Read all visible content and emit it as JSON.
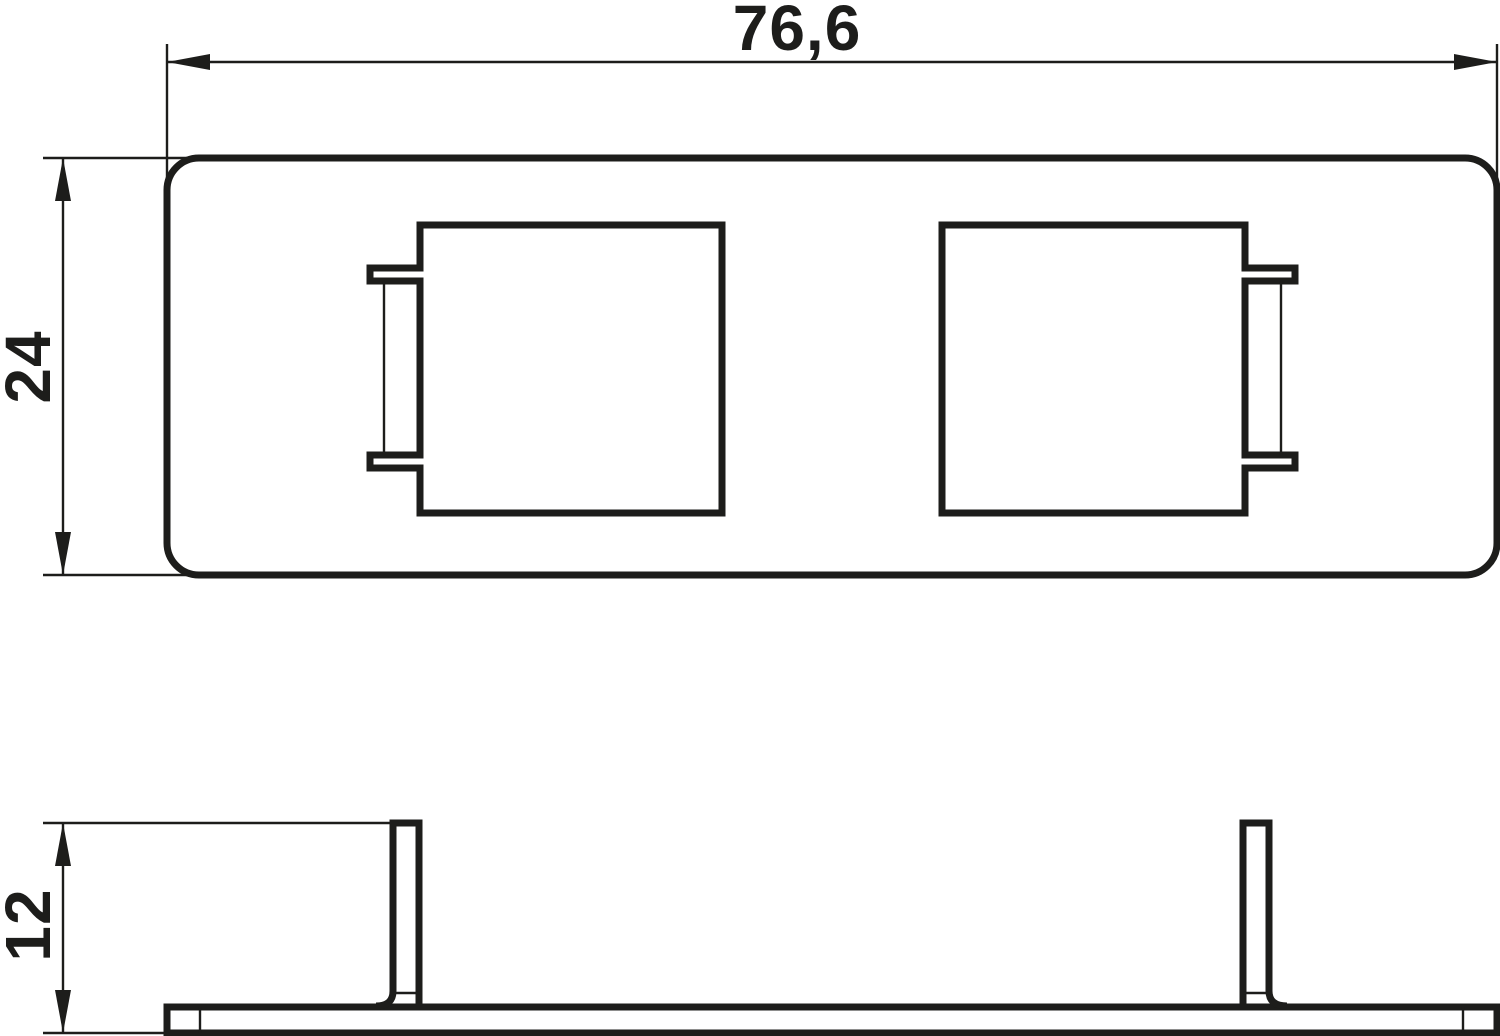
{
  "drawing": {
    "background_color": "#ffffff",
    "line_color": "#1d1d1b",
    "dimension_labels": {
      "width": "76,6",
      "height": "24",
      "depth": "12"
    }
  }
}
